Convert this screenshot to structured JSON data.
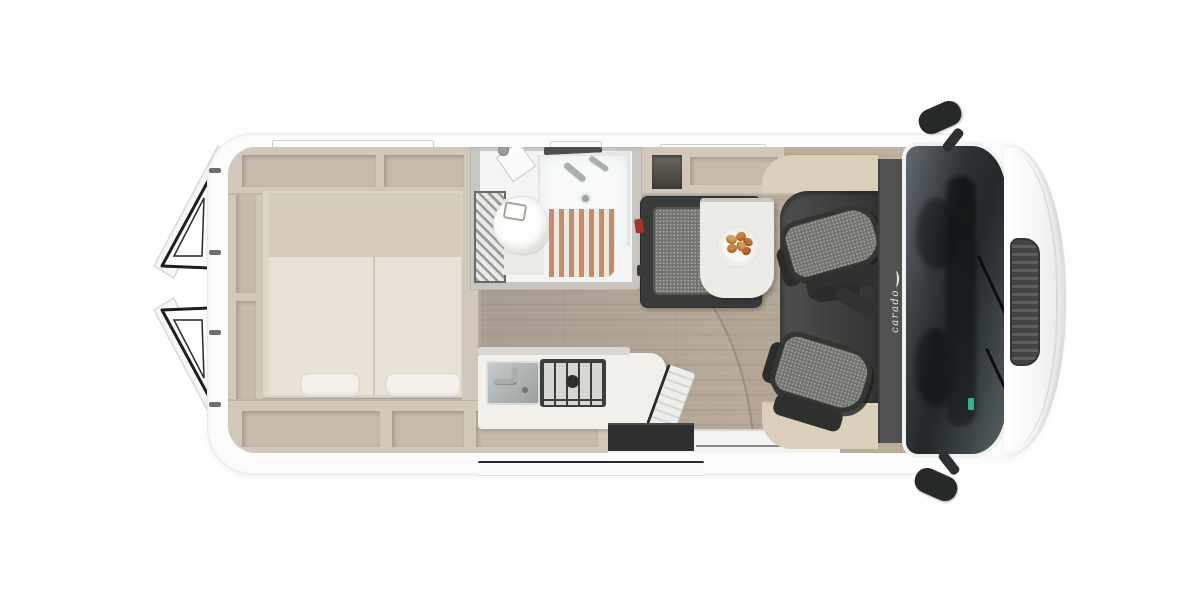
{
  "brand": {
    "logo_text": "carado"
  },
  "palette": {
    "furniture": "#d2c8ba",
    "furniture_inset": "#c6baa9",
    "bed": "#e8e2d5",
    "bed_head": "#d5ccbc",
    "pillow": "#f3f0e9",
    "bath_white": "#f3f4f3",
    "grate_wood": "#c48d68",
    "bench_dark": "#3a3c3b",
    "belt_buckle": "#a8342b",
    "step_dark": "#2f3130",
    "cab_trim": "#dbcfba",
    "roof_band": "#515352",
    "glass_dark": "#2e3437",
    "body_white": "#fcfcfc",
    "floor_wood": "#ac9f93",
    "food_accent": "#cf8f4e"
  },
  "floorplan": {
    "vehicle": "camper-van-top-view",
    "zones": [
      "open-rear-doors",
      "rear-storage-shelves",
      "transverse-double-bed",
      "bathroom-with-shower-and-toilet",
      "wardrobe",
      "dinette-bench",
      "dining-table-with-plate",
      "kitchen-sink-and-hob",
      "sliding-door-entry-step",
      "swivel-cab-seats",
      "cockpit-windshield",
      "side-mirrors"
    ]
  }
}
